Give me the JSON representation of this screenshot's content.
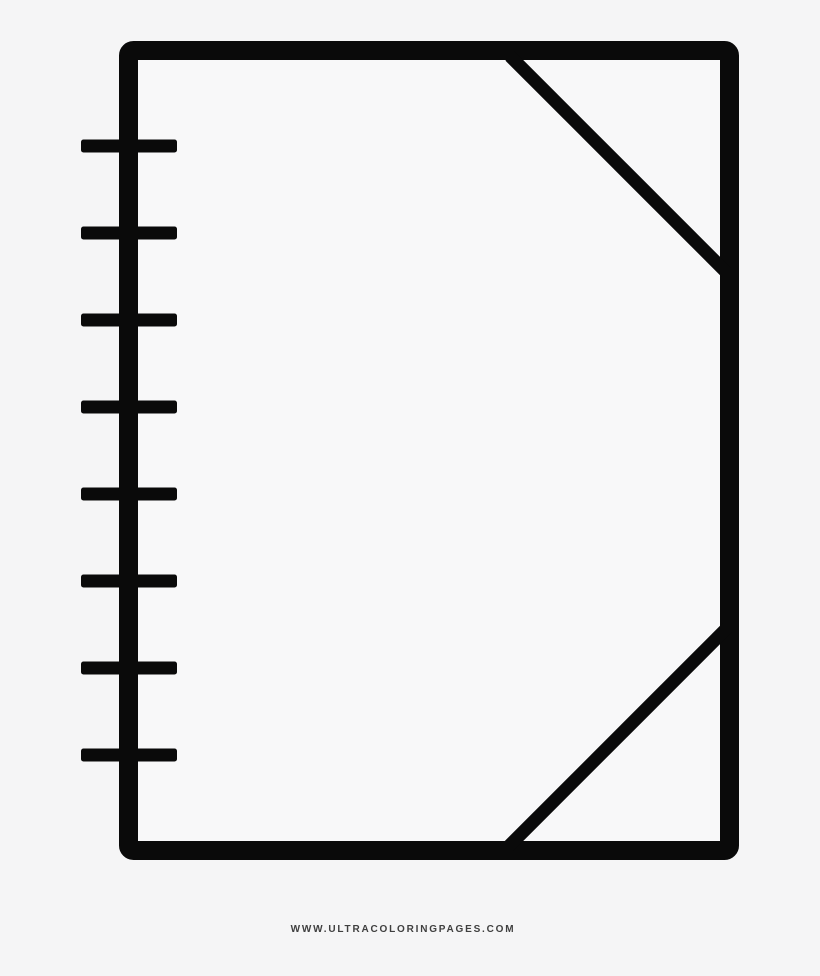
{
  "artwork": {
    "icon": "notebook-line-art-icon",
    "subject": "notebook",
    "binding_rings": 8
  },
  "footer": {
    "watermark": "WWW.ULTRACOLORINGPAGES.COM"
  },
  "colors": {
    "background": "#f5f5f6",
    "line": "#0a0a0a",
    "paper": "#f8f8f9",
    "watermark": "#3f3f3f"
  }
}
